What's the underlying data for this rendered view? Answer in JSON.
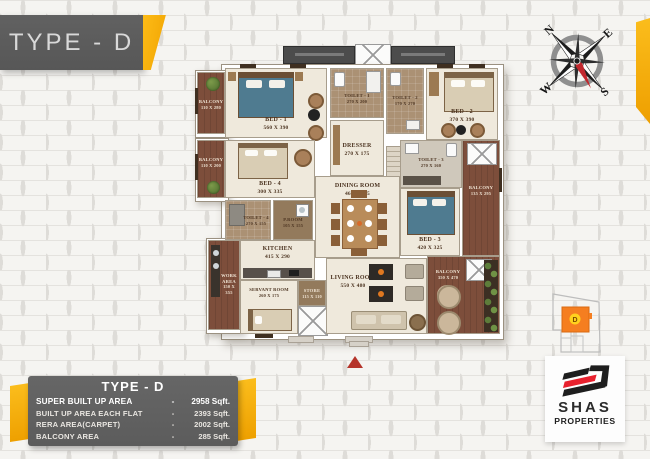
{
  "banner": {
    "title": "TYPE - D"
  },
  "compass": {
    "north": "N",
    "east": "E",
    "south": "S",
    "west": "W"
  },
  "floor_plan": {
    "rooms": [
      {
        "name": "BED - 1",
        "dims": "560 X 390"
      },
      {
        "name": "TOILET - 1",
        "dims": "270 X 200"
      },
      {
        "name": "DRESSER",
        "dims": "270 X 175"
      },
      {
        "name": "TOILET - 2",
        "dims": "170 X 270"
      },
      {
        "name": "BED - 2",
        "dims": "370 X 390"
      },
      {
        "name": "TOILET - 3",
        "dims": "270 X 160"
      },
      {
        "name": "BED - 3",
        "dims": "420 X 325"
      },
      {
        "name": "BALCONY",
        "dims": "135 X 295"
      },
      {
        "name": "BED - 4",
        "dims": "300 X 335"
      },
      {
        "name": "TOILET - 4",
        "dims": "270 X 155"
      },
      {
        "name": "P.ROOM",
        "dims": "105 X 155"
      },
      {
        "name": "DINING ROOM",
        "dims": "460 X 505"
      },
      {
        "name": "KITCHEN",
        "dims": "415 X 290"
      },
      {
        "name": "WORK AREA",
        "dims": "150 X 355"
      },
      {
        "name": "SERVANT ROOM",
        "dims": "260 X 175"
      },
      {
        "name": "STORE",
        "dims": "115 X 110"
      },
      {
        "name": "LIVING ROOM",
        "dims": "550 X 480"
      },
      {
        "name": "BALCONY",
        "dims": "110 X 280"
      },
      {
        "name": "BALCONY",
        "dims": "110 X 200"
      },
      {
        "name": "BALCONY",
        "dims": "350 X 470"
      }
    ]
  },
  "site_key": {
    "unit": "D"
  },
  "spec_table": {
    "title": "TYPE - D",
    "separator": "-",
    "rows": [
      {
        "label": "SUPER BUILT UP AREA",
        "value": "2958 Sqft."
      },
      {
        "label": "BUILT UP AREA EACH FLAT",
        "value": "2393 Sqft."
      },
      {
        "label": "RERA AREA(CARPET)",
        "value": "2002 Sqft."
      },
      {
        "label": "BALCONY AREA",
        "value": "285 Sqft."
      }
    ]
  },
  "logo": {
    "brand": "SHAS",
    "tagline": "PROPERTIES"
  },
  "colors": {
    "accent_yellow": "#F2A900",
    "banner_gray": "#5B5B5B",
    "logo_red": "#E8212E",
    "balcony_brown": "#7D4E3B",
    "floor_cream": "#EFE9DC",
    "site_orange": "#F57E20",
    "marker_red": "#B5342A"
  }
}
